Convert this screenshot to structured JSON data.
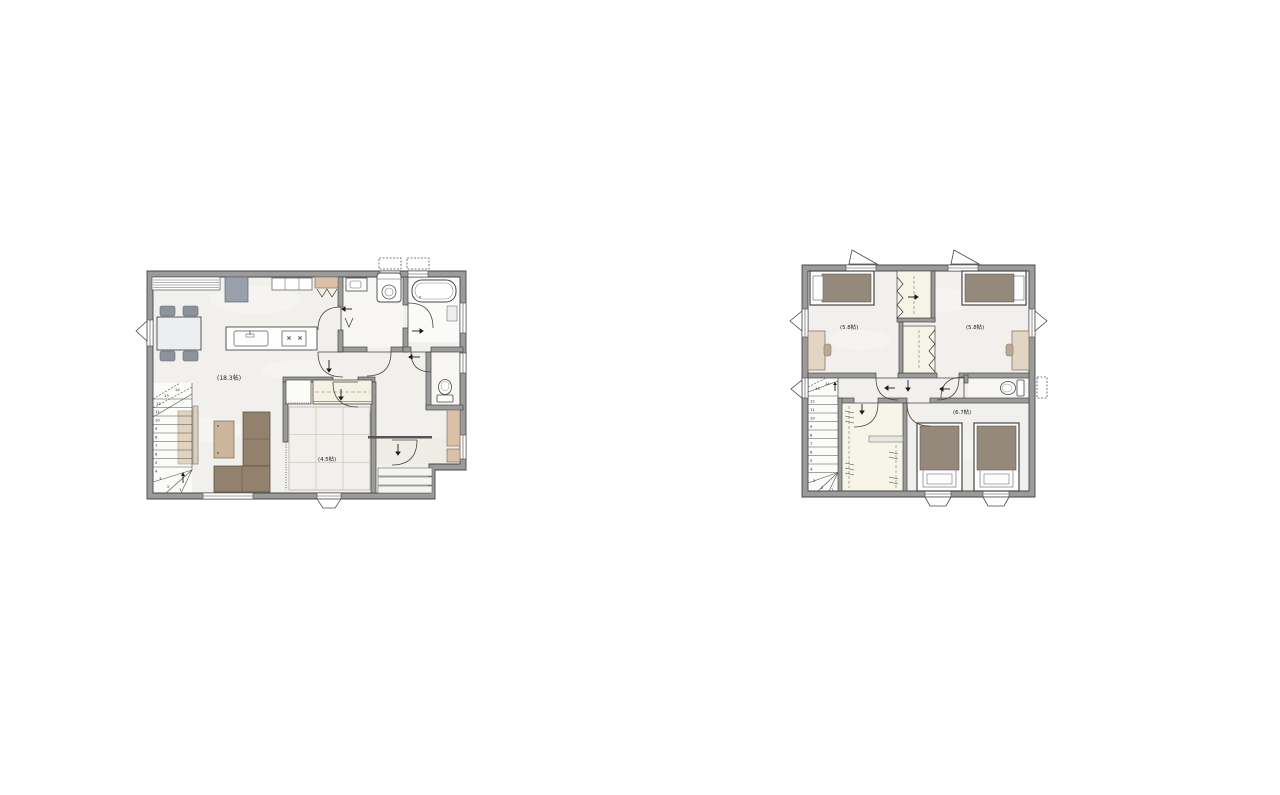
{
  "page": {
    "background": "#ffffff"
  },
  "colors": {
    "wall_fill": "#9b9b9b",
    "wall_edge": "#474747",
    "floor": "#f2f0ec",
    "wet_area_floor": "#f8f7f4",
    "tatami_closet": "#f4f3e3",
    "walk_in_closet_floor": "#f6f5e8",
    "wood_beige": "#d9c0a6",
    "bed_mattress": "#95897b",
    "sofa_brown": "#92826d",
    "furniture_gray": "#98a0ab",
    "rug_beige": "#e2d3bf",
    "arrow_black": "#1a1a1a"
  },
  "floor1": {
    "room_labels": {
      "ldk": "(18.3帖)",
      "tatami": "(4.5帖)"
    },
    "stair_steps": [
      "1",
      "2",
      "3",
      "4",
      "5",
      "6",
      "7",
      "8",
      "9",
      "10",
      "11",
      "12",
      "13",
      "14"
    ]
  },
  "floor2": {
    "room_labels": {
      "bedroom_left": "(5.8帖)",
      "bedroom_right": "(5.8帖)",
      "bedroom_bottom": "(6.7帖)"
    },
    "stair_steps": [
      "1",
      "2",
      "3",
      "4",
      "5",
      "6",
      "7",
      "8",
      "9",
      "10",
      "11",
      "12",
      "13",
      "14"
    ]
  }
}
